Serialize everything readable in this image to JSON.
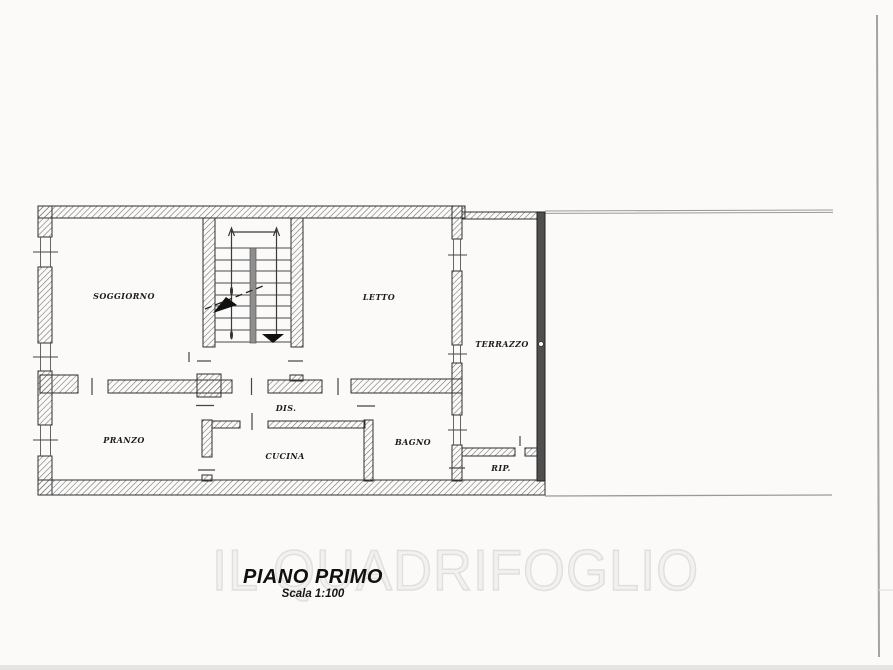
{
  "plan": {
    "title": "PIANO PRIMO",
    "scale": "Scala 1:100",
    "watermark": "IL QUADRIFOGLIO",
    "rooms": [
      {
        "id": "soggiorno",
        "label": "SOGGIORNO"
      },
      {
        "id": "letto",
        "label": "LETTO"
      },
      {
        "id": "terrazzo",
        "label": "TERRAZZO"
      },
      {
        "id": "pranzo",
        "label": "PRANZO"
      },
      {
        "id": "dis",
        "label": "DIS."
      },
      {
        "id": "cucina",
        "label": "CUCINA"
      },
      {
        "id": "bagno",
        "label": "BAGNO"
      },
      {
        "id": "rip",
        "label": "RIP."
      }
    ],
    "colors": {
      "wall_line": "#2e2e2e",
      "hatch": "#6a6a6a",
      "solid_wall": "#4f4f4f",
      "stair_stringer": "#8e8e8e",
      "scan_line": "#9a9a9a",
      "label_ink": "#1c1c1c"
    }
  }
}
